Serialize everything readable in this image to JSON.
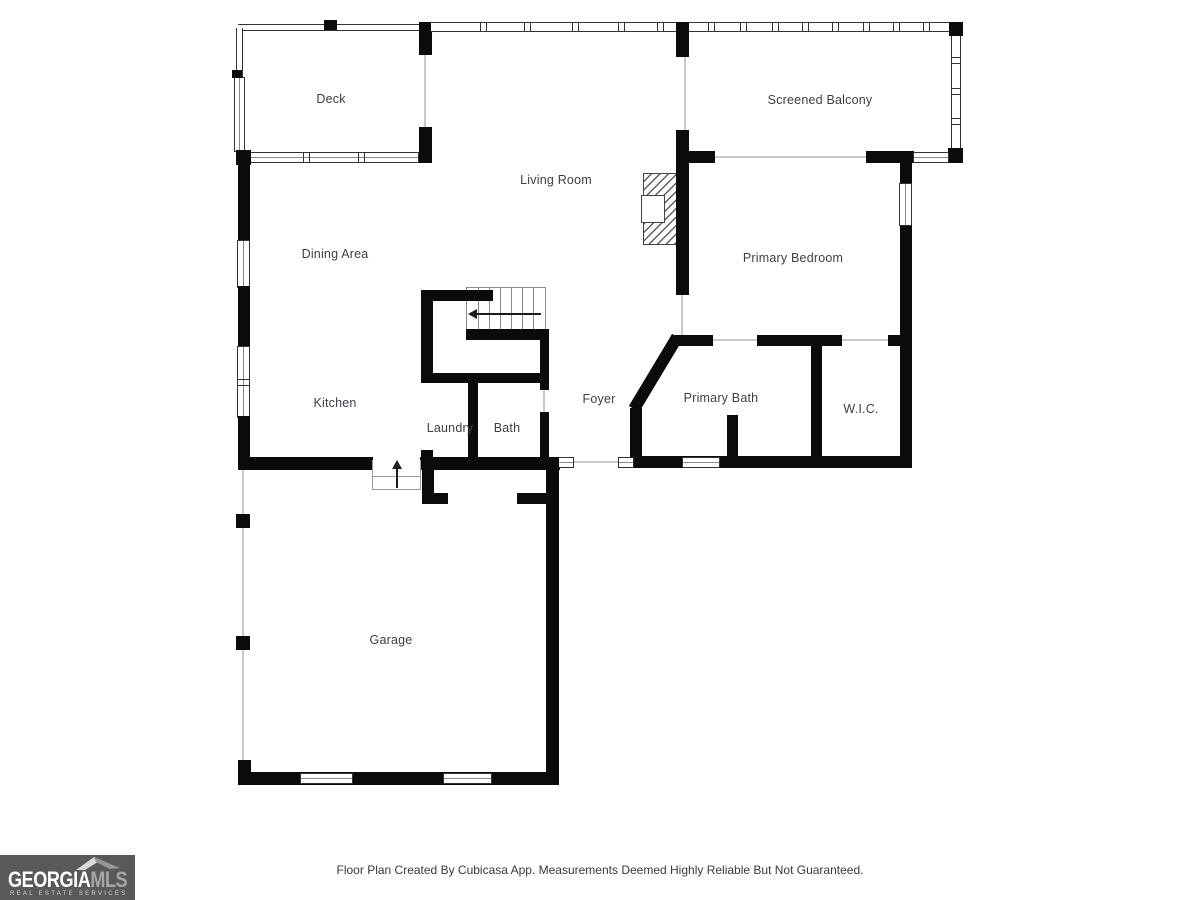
{
  "rooms": [
    {
      "name": "Deck"
    },
    {
      "name": "Living Room"
    },
    {
      "name": "Screened Balcony"
    },
    {
      "name": "Dining Area"
    },
    {
      "name": "Primary Bedroom"
    },
    {
      "name": "Kitchen"
    },
    {
      "name": "Foyer"
    },
    {
      "name": "Primary Bath"
    },
    {
      "name": "W.I.C."
    },
    {
      "name": "Laundry"
    },
    {
      "name": "Bath"
    },
    {
      "name": "Garage"
    }
  ],
  "footer": {
    "disclaimer": "Floor Plan Created By Cubicasa App. Measurements Deemed Highly Reliable But Not Guaranteed."
  },
  "logo": {
    "brand_primary": "GEORGIA",
    "brand_secondary": "MLS",
    "tagline": "REAL ESTATE SERVICES"
  },
  "colors": {
    "wall": "#0b0b0b",
    "label_text": "#3f4046",
    "logo_background": "#59595b",
    "page_background": "#ffffff"
  }
}
